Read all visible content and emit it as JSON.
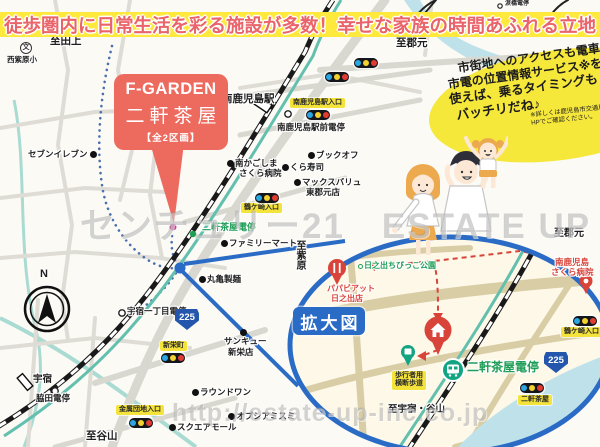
{
  "banner": {
    "text": "徒歩圏内に日常生活を彩る施設が多数！幸せな家族の時間あふれる立地"
  },
  "property": {
    "brand": "F-GARDEN",
    "name": "二軒茶屋",
    "units": "【全2区画】"
  },
  "speech_bubble": {
    "line1": "市街地へのアクセスも電車1本！",
    "line2": "市電の位置情報サービス※を",
    "line3": "使えば、乗るタイミングも",
    "line4": "バッチリだね♪",
    "note1": "※詳しくは鹿児島市交通局の",
    "note2": "HPでご確認ください。"
  },
  "watermark": {
    "center": "センチュリー21　ESTATE UP",
    "url": "http://estate-up-inc.co.jp"
  },
  "route_shield": {
    "number": "225"
  },
  "labels": {
    "compass_n": "N",
    "to_tagami": "至田上",
    "school_symbol": "文",
    "nishi_murasakibaru_elem": "西紫原小",
    "to_korimoto": "至郡元",
    "namidabashi_stop": "涙橋電停",
    "minami_kagoshima_sta": "南鹿児島駅",
    "minami_sta_entrance": "南鹿児島駅入口",
    "minami_ekimae_stop": "南鹿児島駅前電停",
    "seven_eleven": "セブンイレブン",
    "sakura_hosp_1": "南かごしま",
    "sakura_hosp_2": "さくら病院",
    "book_off": "ブックオフ",
    "kura_sushi": "くら寿司",
    "max_valu_1": "マックスバリュ",
    "max_valu_2": "東郡元店",
    "tsurugasaki_entrance": "鶴ケ崎入口",
    "nikenjaya_teiryujo": "二軒茶屋電停",
    "family_mart": "ファミリーマート",
    "to_murasakibaru": "至紫原",
    "marugame_seimen": "丸亀製麺",
    "usuki_1chome_stop": "宇宿一丁目電停",
    "shinei_cho": "新栄町",
    "sankyu_1": "サンキュー",
    "sankyu_2": "新栄店",
    "round_one": "ラウンドワン",
    "opsia_misumi": "オプシアミスミ",
    "square_mall": "スクエアモール",
    "kinzoku_danchi_entrance": "金属団地入口",
    "usuki_sta": "宇宿",
    "wakida_stop": "脇田電停",
    "to_taniyama": "至谷山",
    "hinode_park": "日之出ちびっこ公園",
    "papabiatto_1": "パパビアット",
    "papabiatto_2": "日之出店",
    "kakudaizu": "拡大図",
    "mk_sakura_hosp_1": "南鹿児島",
    "mk_sakura_hosp_2": "さくら病院",
    "hokoshayo_1": "歩行者用",
    "hokoshayo_2": "横断歩道",
    "to_usuki_taniyama": "至宇宿・谷山",
    "nikenjaya_crossing": "二軒茶屋"
  },
  "colors": {
    "accent_red": "#ed6a5e",
    "banner_yellow": "#ffe93c",
    "callout_blue": "#2a6bc6",
    "tram_green": "#1f9e57",
    "poi_red": "#d8433a"
  }
}
